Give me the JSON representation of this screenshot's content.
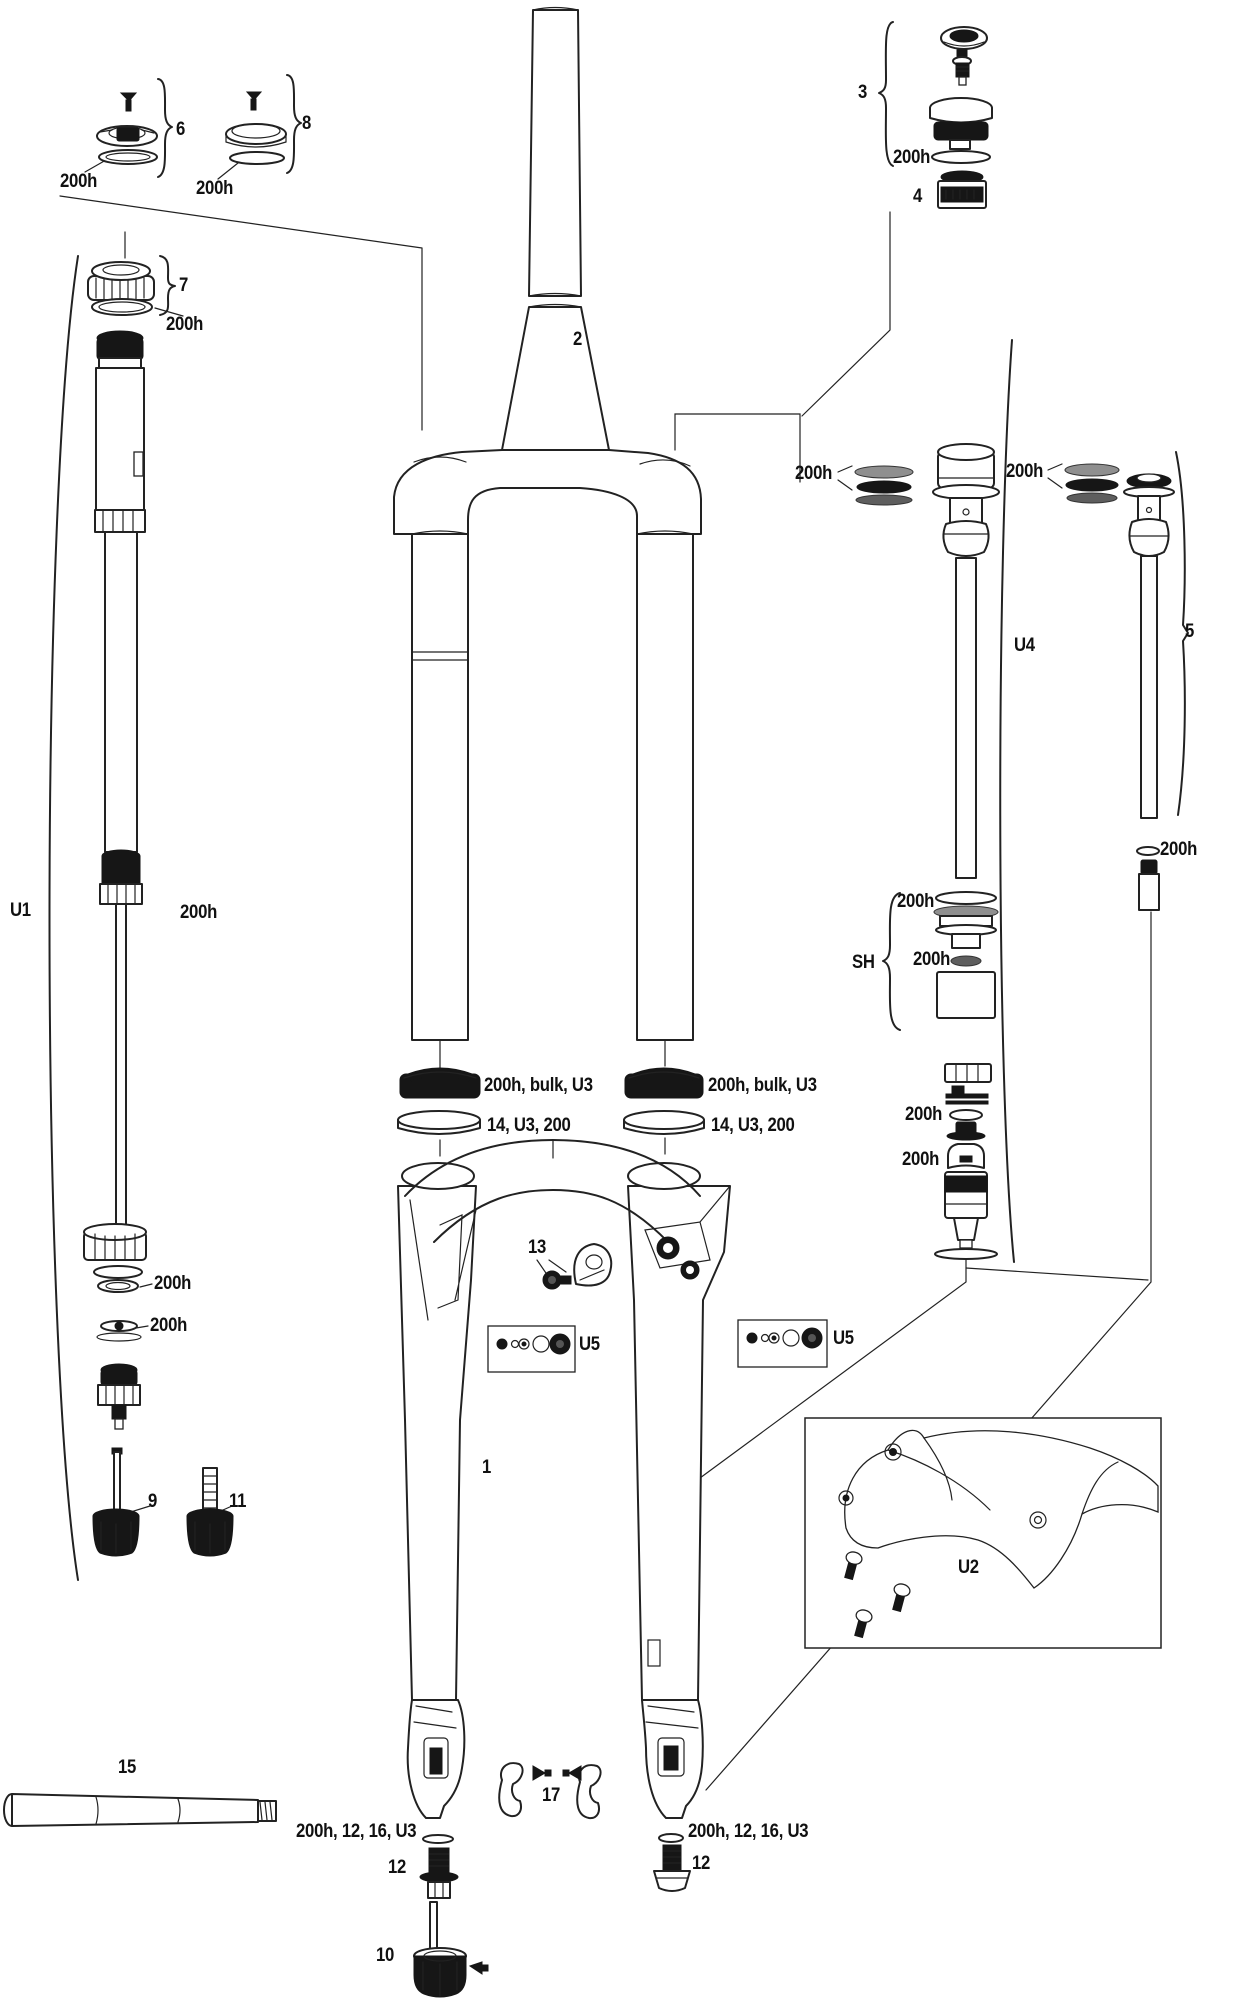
{
  "document": {
    "type": "exploded-parts-diagram",
    "subject": "suspension-fork"
  },
  "colors": {
    "background": "#ffffff",
    "ink": "#222222",
    "dark_part": "#161616",
    "seal_grey": "#8f8f8f"
  },
  "labels": {
    "p1": "1",
    "p2": "2",
    "p3": "3",
    "p4": "4",
    "p5": "5",
    "p6": "6",
    "p7": "7",
    "p8": "8",
    "p9": "9",
    "p10": "10",
    "p11": "11",
    "p12": "12",
    "p13": "13",
    "p15": "15",
    "p17": "17",
    "u1": "U1",
    "u2": "U2",
    "u4": "U4",
    "u5": "U5",
    "sh": "SH",
    "h200": "200h",
    "h200_bulk_u3": "200h, bulk, U3",
    "s14_u3_200": "14, U3, 200",
    "h200_12_16_u3": "200h, 12, 16, U3"
  }
}
